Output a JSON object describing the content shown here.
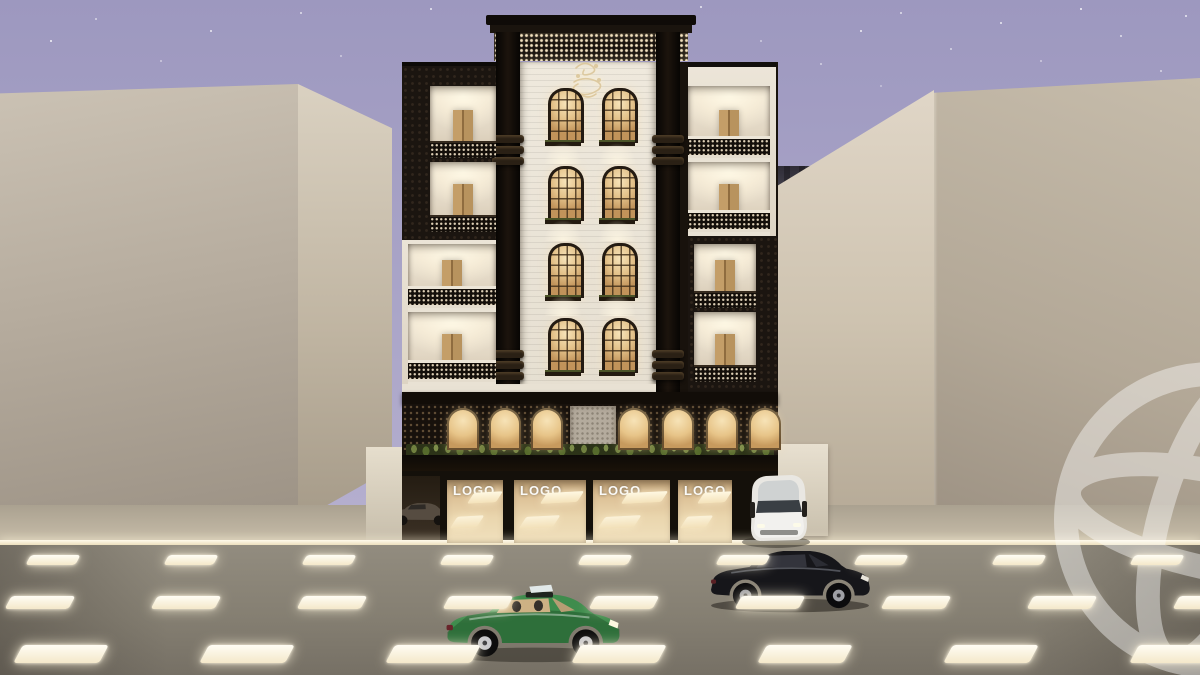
{
  "scene": {
    "type": "3D architectural exterior render",
    "time_of_day": "dusk",
    "description": "Five-storey Arabic-style apartment building with black perforated mashrabiya panels, backlit arched windows, balconies, an arcaded mezzanine with planting and four lit retail storefronts; beige neighbouring buildings, an illuminated street with cars and a starry lavender sky.",
    "colors": {
      "sky_top": "#9d98bf",
      "sky_bottom": "#bcb5d3",
      "facade_dark": "#18120c",
      "facade_light": "#ece5d9",
      "window_glow": "#f0d8a8",
      "street": "#878174",
      "neighbor_building": "#c0b6a5",
      "greenery": "#64743c",
      "curb_light": "#fdf4df"
    }
  },
  "building": {
    "storeys": 5,
    "balconies": 8,
    "arched_window_pairs": 4,
    "arcade_arches": 7,
    "emblem": "arabic-calligraphy-crest",
    "crown": "perforated-backlit-parapet"
  },
  "storefronts": {
    "count": 4,
    "signs": [
      {
        "label": "LOGO"
      },
      {
        "label": "LOGO"
      },
      {
        "label": "LOGO"
      },
      {
        "label": "LOGO"
      }
    ]
  },
  "vehicles": [
    {
      "name": "green-sedan",
      "color": "#3f8c4d",
      "position": "street foreground, facing right"
    },
    {
      "name": "black-sedan",
      "color": "#141418",
      "position": "street far lane, facing right"
    },
    {
      "name": "white-car-parked",
      "color": "#e9e7e2",
      "position": "sidewalk right of storefronts"
    },
    {
      "name": "grey-car-parked",
      "color": "#564c41",
      "position": "left driveway, partially hidden"
    }
  ],
  "watermark": {
    "name": "globe-watermark",
    "color": "#ffffff",
    "opacity": 0.42,
    "position": "right edge"
  },
  "street": {
    "lit_lane_dashes": true,
    "dash_rows": 3,
    "curb_light_strip": true
  }
}
